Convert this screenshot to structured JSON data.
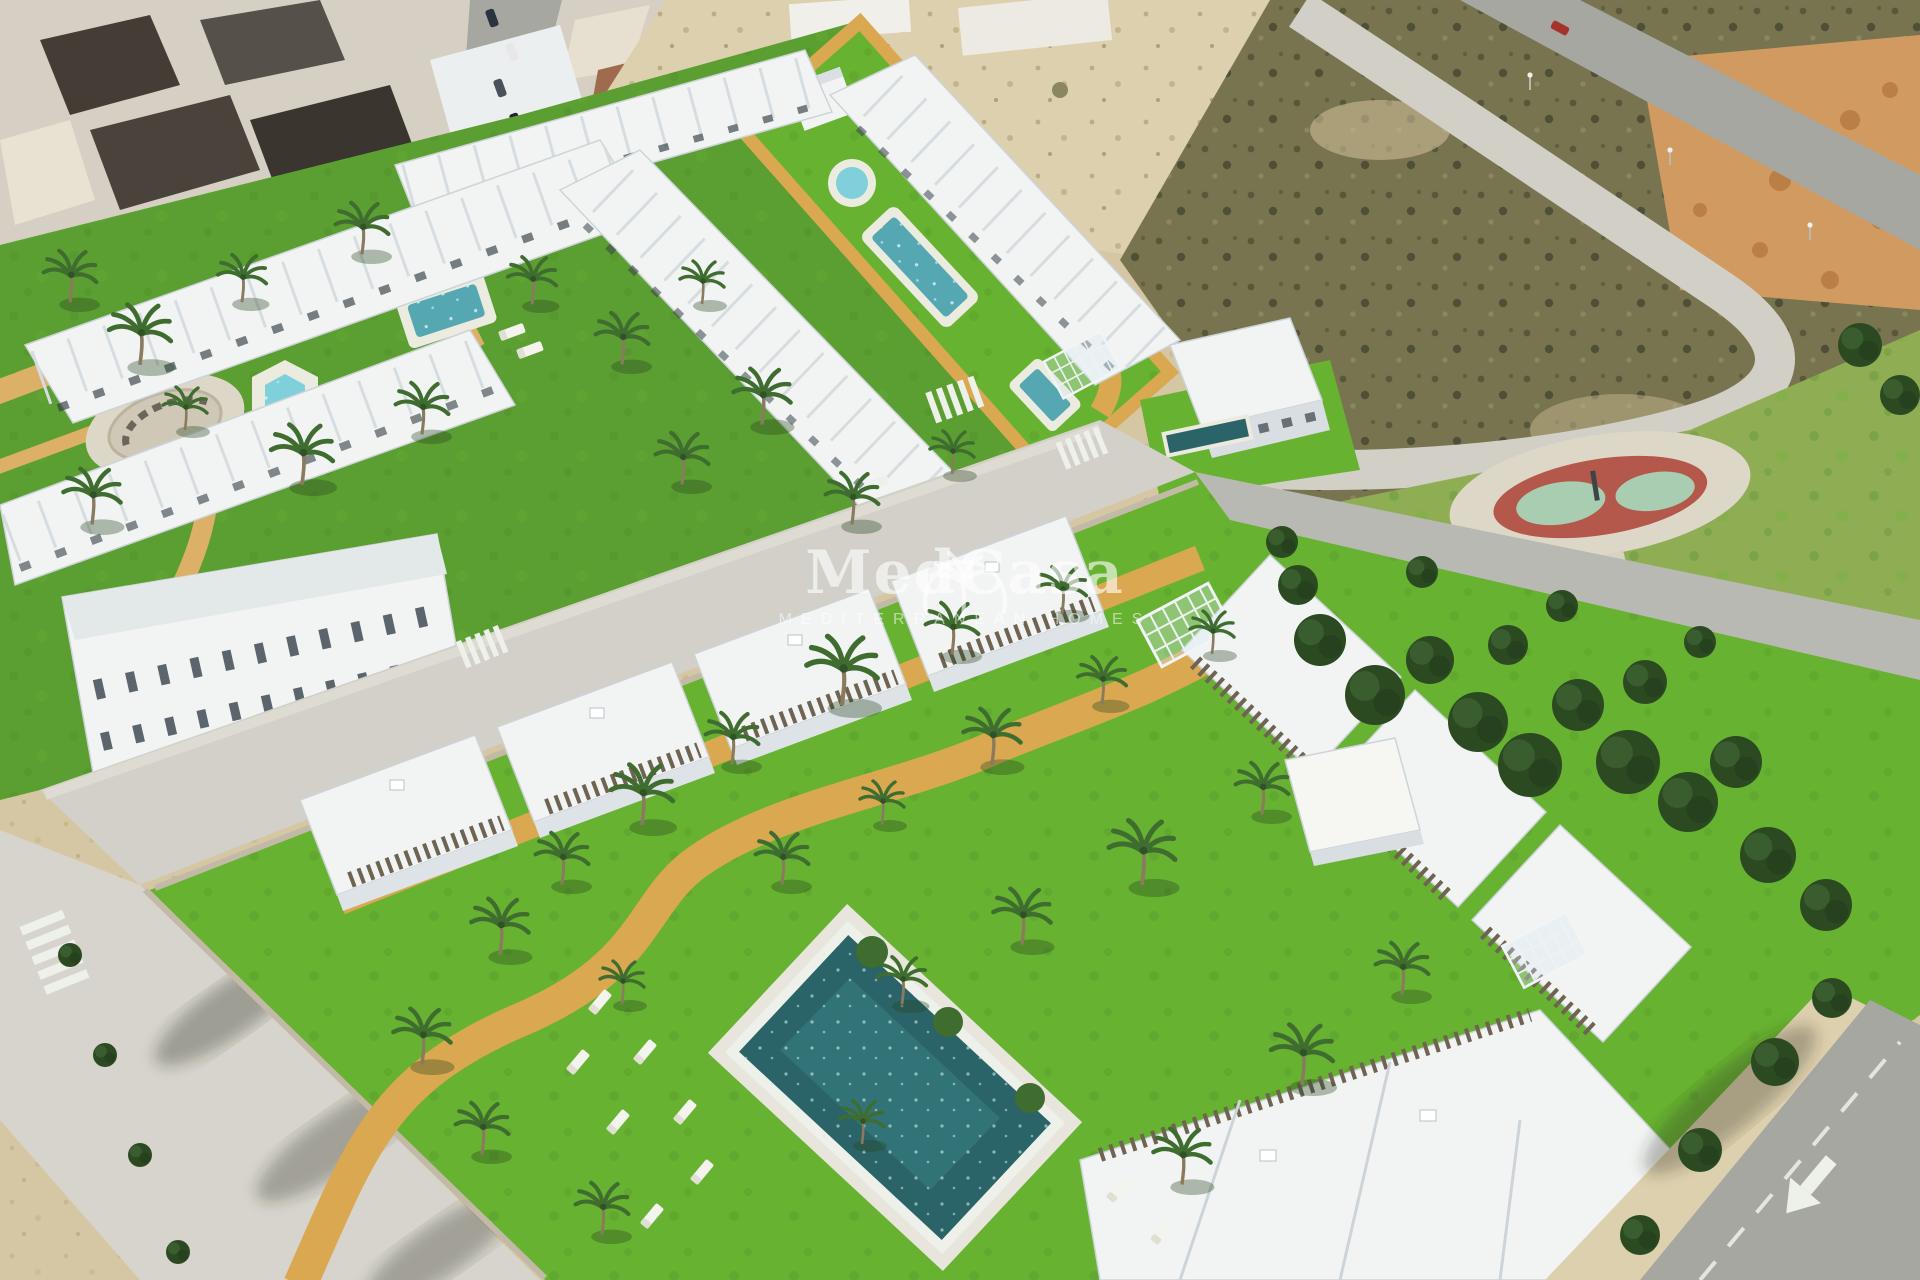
{
  "meta": {
    "title": "MedCasa Mediterranean Homes"
  },
  "watermark": {
    "brand": "MedCasa",
    "tagline": "MEDITERRANEAN HOMES",
    "logo_icon": "palm-globe-icon",
    "color": "#ffffff"
  },
  "palette": {
    "sand": "#d5c7a3",
    "sand-light": "#ddd0ae",
    "scrub": "#787450",
    "dirt-orange": "#d09a60",
    "road-light": "#d2d0c8",
    "road-asphalt": "#a5a7a0",
    "building-white": "#f2f4f4",
    "roof-gray": "#dde3e6",
    "grass": "#5b9e31",
    "grass-bright": "#67b231",
    "park-green": "#8fae54",
    "pool-deep": "#2a6468",
    "pool-mid": "#55a7b2",
    "pool-light": "#7fd0da",
    "pool-rim": "#ecebe0",
    "path-yellow": "#d9a851",
    "pergola": "#6f6352",
    "plaza": "#ddd7c7",
    "playground-red": "#b4584c",
    "playground-mint": "#a9cdb0",
    "tree-dark": "#2c4a22",
    "palm-green": "#3f6c2f",
    "wall": "#c2baa6",
    "town-roof": "#433d36",
    "watermark": "#ffffff"
  }
}
